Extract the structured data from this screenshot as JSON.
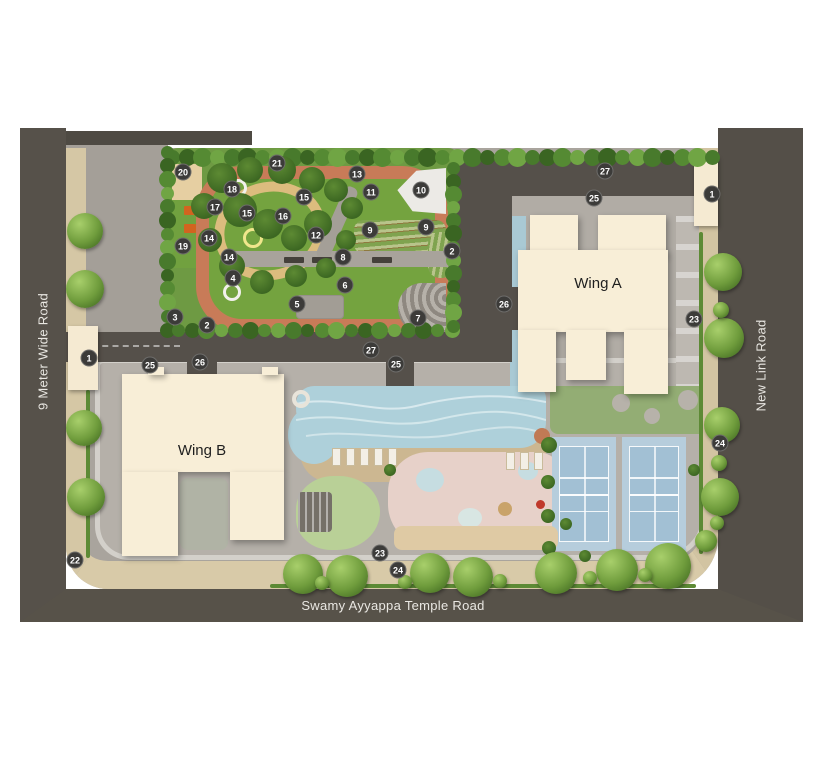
{
  "plan": {
    "roads": {
      "left": "9 Meter Wide Road",
      "right": "New Link Road",
      "bottom": "Swamy Ayyappa Temple Road"
    },
    "buildings": {
      "wing_a": "Wing A",
      "wing_b": "Wing B"
    },
    "markers": [
      {
        "n": "1",
        "x": 89,
        "y": 358
      },
      {
        "n": "1",
        "x": 712,
        "y": 194
      },
      {
        "n": "2",
        "x": 207,
        "y": 325
      },
      {
        "n": "2",
        "x": 452,
        "y": 251
      },
      {
        "n": "3",
        "x": 175,
        "y": 317
      },
      {
        "n": "4",
        "x": 233,
        "y": 278
      },
      {
        "n": "5",
        "x": 297,
        "y": 304
      },
      {
        "n": "6",
        "x": 345,
        "y": 285
      },
      {
        "n": "7",
        "x": 418,
        "y": 318
      },
      {
        "n": "8",
        "x": 343,
        "y": 257
      },
      {
        "n": "9",
        "x": 370,
        "y": 230
      },
      {
        "n": "9",
        "x": 426,
        "y": 227
      },
      {
        "n": "10",
        "x": 421,
        "y": 190
      },
      {
        "n": "11",
        "x": 371,
        "y": 192
      },
      {
        "n": "12",
        "x": 316,
        "y": 235
      },
      {
        "n": "13",
        "x": 357,
        "y": 174
      },
      {
        "n": "14",
        "x": 209,
        "y": 238
      },
      {
        "n": "14",
        "x": 229,
        "y": 257
      },
      {
        "n": "15",
        "x": 304,
        "y": 197
      },
      {
        "n": "15",
        "x": 247,
        "y": 213
      },
      {
        "n": "16",
        "x": 283,
        "y": 216
      },
      {
        "n": "17",
        "x": 215,
        "y": 207
      },
      {
        "n": "18",
        "x": 232,
        "y": 189
      },
      {
        "n": "19",
        "x": 183,
        "y": 246
      },
      {
        "n": "20",
        "x": 183,
        "y": 172
      },
      {
        "n": "21",
        "x": 277,
        "y": 163
      },
      {
        "n": "22",
        "x": 75,
        "y": 560
      },
      {
        "n": "23",
        "x": 694,
        "y": 319
      },
      {
        "n": "23",
        "x": 380,
        "y": 553
      },
      {
        "n": "24",
        "x": 720,
        "y": 443
      },
      {
        "n": "24",
        "x": 398,
        "y": 570
      },
      {
        "n": "25",
        "x": 150,
        "y": 365
      },
      {
        "n": "25",
        "x": 396,
        "y": 364
      },
      {
        "n": "25",
        "x": 594,
        "y": 198
      },
      {
        "n": "26",
        "x": 200,
        "y": 362
      },
      {
        "n": "26",
        "x": 504,
        "y": 304
      },
      {
        "n": "27",
        "x": 605,
        "y": 171
      },
      {
        "n": "27",
        "x": 371,
        "y": 350
      }
    ],
    "colors": {
      "road": "#56514a",
      "sidewalk": "#d5c7a5",
      "paving": "#a9a49d",
      "lawn": "#74a33f",
      "jogging_track": "#c87b58",
      "building": "#f8eed7",
      "pool": "#aed0da",
      "tennis_court": "#b6cddc",
      "play_area": "#e7d1c9",
      "marker_badge": "#3c3b39"
    }
  }
}
